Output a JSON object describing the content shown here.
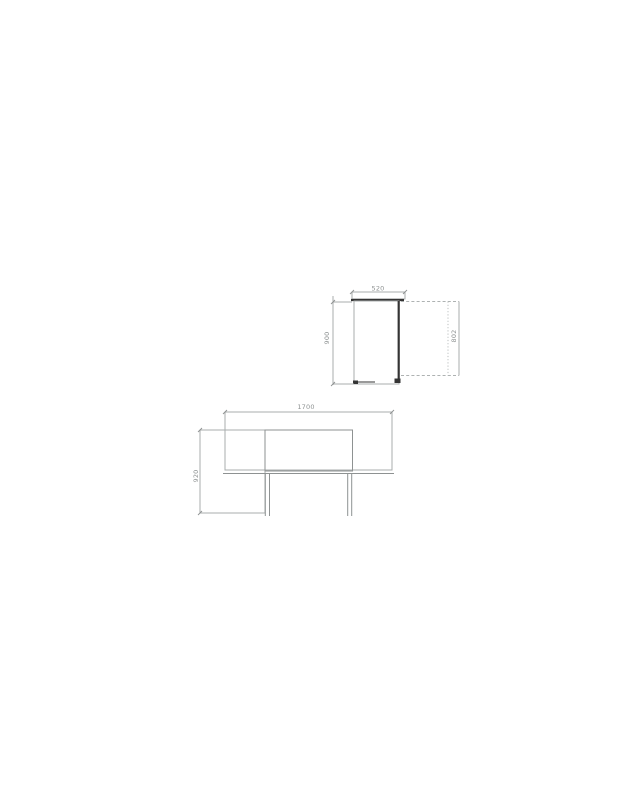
{
  "page": {
    "background": "#ffffff"
  },
  "palette": {
    "line_light": "#a9adad",
    "line_mid": "#8e9292",
    "line_dark": "#343434",
    "dim_text": "#8e9292"
  },
  "side_view": {
    "dims": {
      "width": "520",
      "height": "900",
      "door": "802"
    }
  },
  "front_view": {
    "dims": {
      "width": "1700",
      "height": "920"
    }
  }
}
